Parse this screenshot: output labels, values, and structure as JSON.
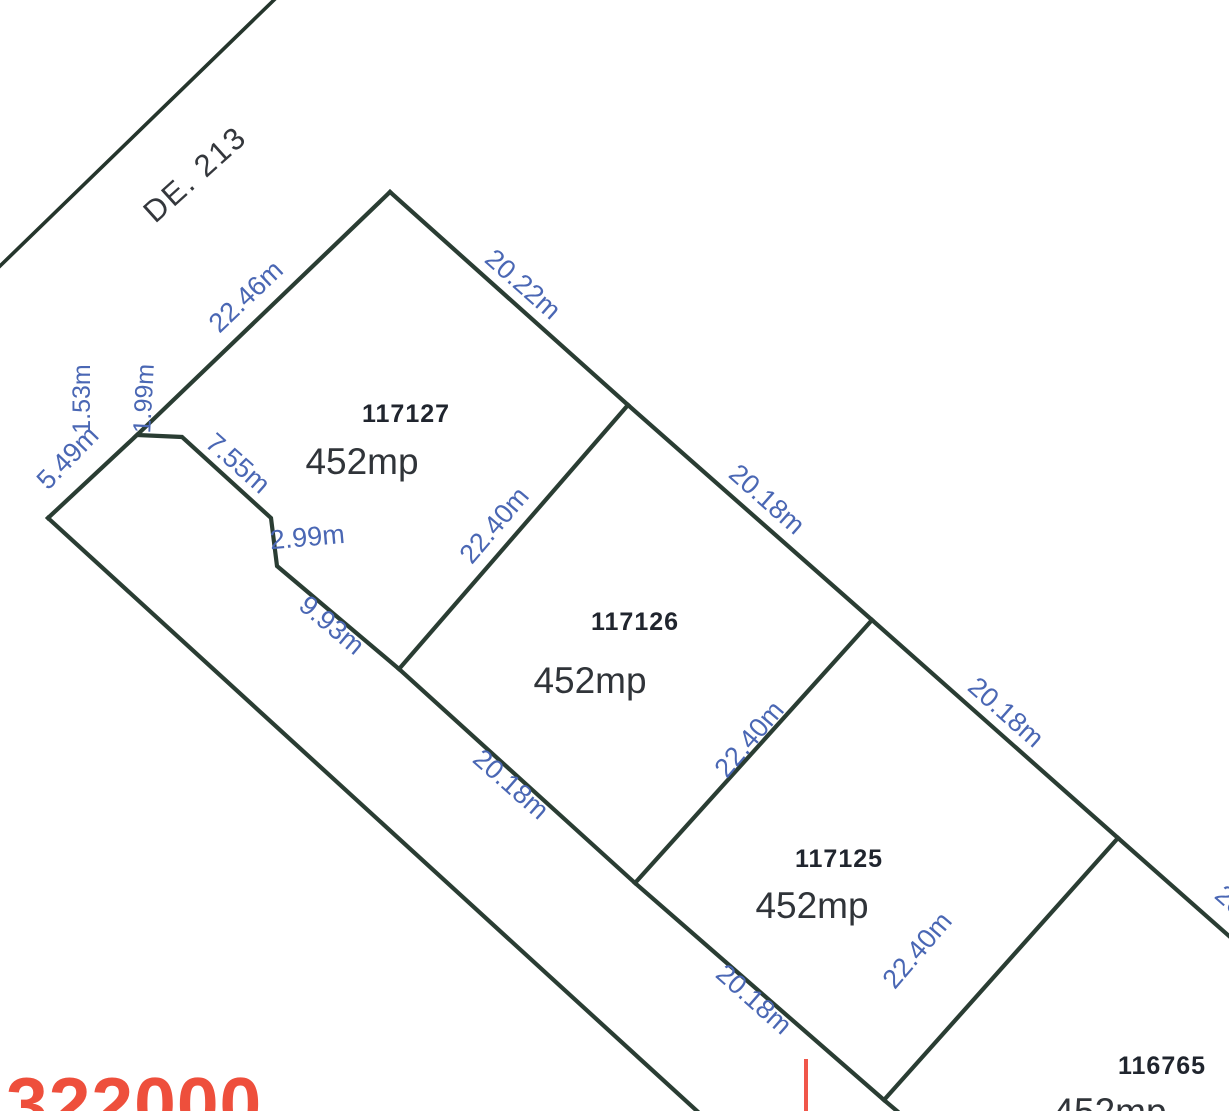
{
  "map": {
    "road_label": "DE. 213",
    "grid_label": "322000",
    "parcels": [
      {
        "id": "117127",
        "area": "452mp"
      },
      {
        "id": "117126",
        "area": "452mp"
      },
      {
        "id": "117125",
        "area": "452mp"
      },
      {
        "id": "116765",
        "area": "452mp"
      }
    ],
    "dimensions": [
      {
        "text": "22.46m"
      },
      {
        "text": "20.22m"
      },
      {
        "text": "20.18m"
      },
      {
        "text": "20.18m"
      },
      {
        "text": "20.18m"
      },
      {
        "text": "20.18m"
      },
      {
        "text": "22.40m"
      },
      {
        "text": "22.40m"
      },
      {
        "text": "22.40m"
      },
      {
        "text": "7.55m"
      },
      {
        "text": "2.99m"
      },
      {
        "text": "9.93m"
      },
      {
        "text": "5.49m"
      },
      {
        "text": "1.53m"
      },
      {
        "text": "1.99m"
      },
      {
        "text": "20.18m"
      }
    ],
    "colors": {
      "boundary_line": "#2a3d33",
      "dimension_text": "#4a67b4",
      "parcel_id_text": "#20252e",
      "area_text": "#303439",
      "road_text": "#34373c",
      "grid_red": "#ee4f3c"
    }
  }
}
